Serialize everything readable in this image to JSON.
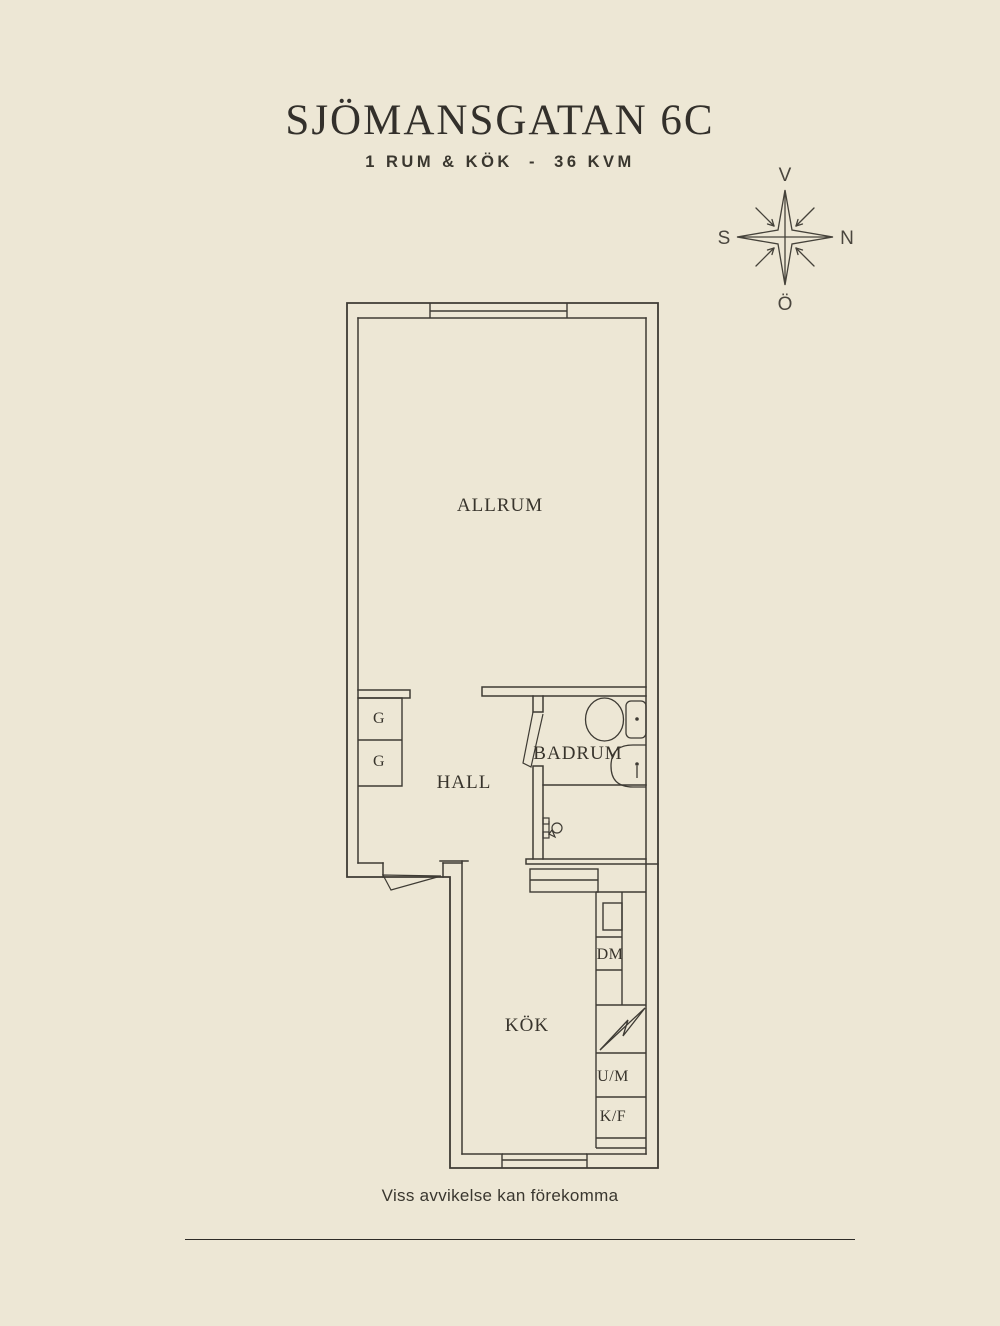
{
  "header": {
    "title": "SJÖMANSGATAN 6C",
    "subtitle": "1 RUM & KÖK  -  36 KVM"
  },
  "compass": {
    "top": "V",
    "right": "N",
    "left": "S",
    "bottom": "Ö"
  },
  "floor_plan": {
    "rooms": [
      {
        "id": "allrum",
        "label": "ALLRUM"
      },
      {
        "id": "hall",
        "label": "HALL"
      },
      {
        "id": "badrum",
        "label": "BADRUM"
      },
      {
        "id": "kok",
        "label": "KÖK"
      }
    ],
    "fixtures": [
      {
        "id": "closet-1",
        "label": "G"
      },
      {
        "id": "closet-2",
        "label": "G"
      },
      {
        "id": "dishwasher",
        "label": "DM"
      },
      {
        "id": "oven-microwave",
        "label": "U/M"
      },
      {
        "id": "fridge-freezer",
        "label": "K/F"
      }
    ]
  },
  "footer": {
    "disclaimer": "Viss avvikelse kan förekomma"
  },
  "colors": {
    "background": "#EDE7D5",
    "line": "#3E3B34",
    "text": "#34312A"
  }
}
